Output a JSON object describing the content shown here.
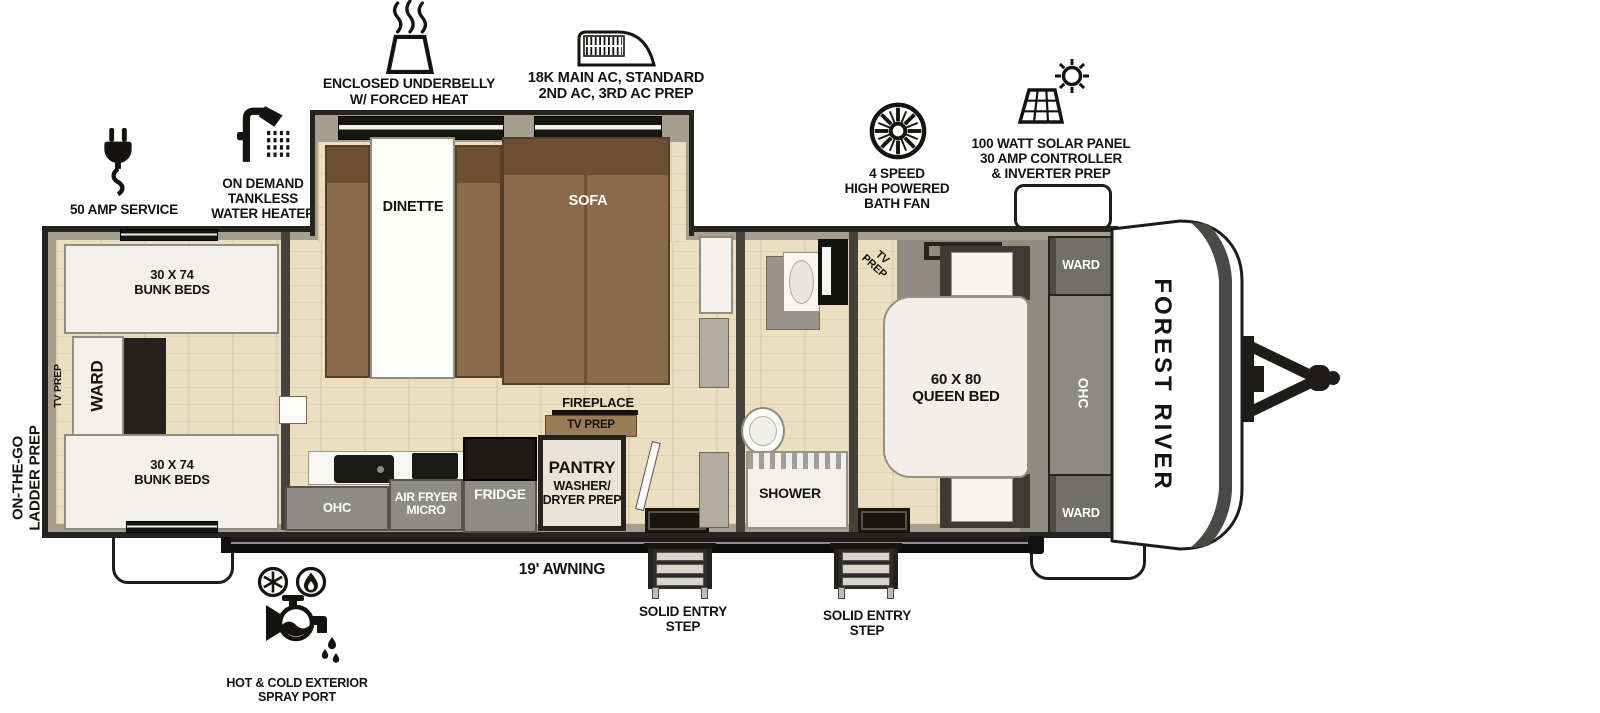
{
  "brand": "FOREST RIVER",
  "features": {
    "amp_service": "50 AMP SERVICE",
    "water_heater": "ON DEMAND\nTANKLESS\nWATER HEATER",
    "underbelly": "ENCLOSED UNDERBELLY\nW/ FORCED HEAT",
    "ac": "18K MAIN AC, STANDARD\n2ND AC, 3RD AC PREP",
    "bath_fan": "4 SPEED\nHIGH POWERED\nBATH FAN",
    "solar": "100 WATT SOLAR PANEL\n30 AMP CONTROLLER\n& INVERTER PREP",
    "spray_port": "HOT & COLD EXTERIOR\nSPRAY PORT",
    "ladder_prep": "ON-THE-GO\nLADDER PREP",
    "awning": "19' AWNING",
    "entry_step": "SOLID ENTRY\nSTEP"
  },
  "rooms": {
    "bunk_beds": "30 X 74\nBUNK BEDS",
    "ward": "WARD",
    "tv_prep": "TV PREP",
    "tv_prep_stacked": "TV\nPREP",
    "dinette": "DINETTE",
    "sofa": "SOFA",
    "ohc": "OHC",
    "air_fryer_micro": "AIR FRYER\nMICRO",
    "fridge": "FRIDGE",
    "pantry": "PANTRY",
    "pantry_sub": "WASHER/\nDRYER PREP",
    "fireplace": "FIREPLACE",
    "shower": "SHOWER",
    "queen_bed": "60 X 80\nQUEEN BED"
  },
  "colors": {
    "outline": "#26241f",
    "wall": "#a79e8e",
    "floor_wood": "#ecdfc0",
    "upholstery_brown": "#8a6a4b",
    "cabinet_gray": "#8d8c88",
    "stripe_gray": "#4a4947",
    "white": "#ffffff"
  }
}
